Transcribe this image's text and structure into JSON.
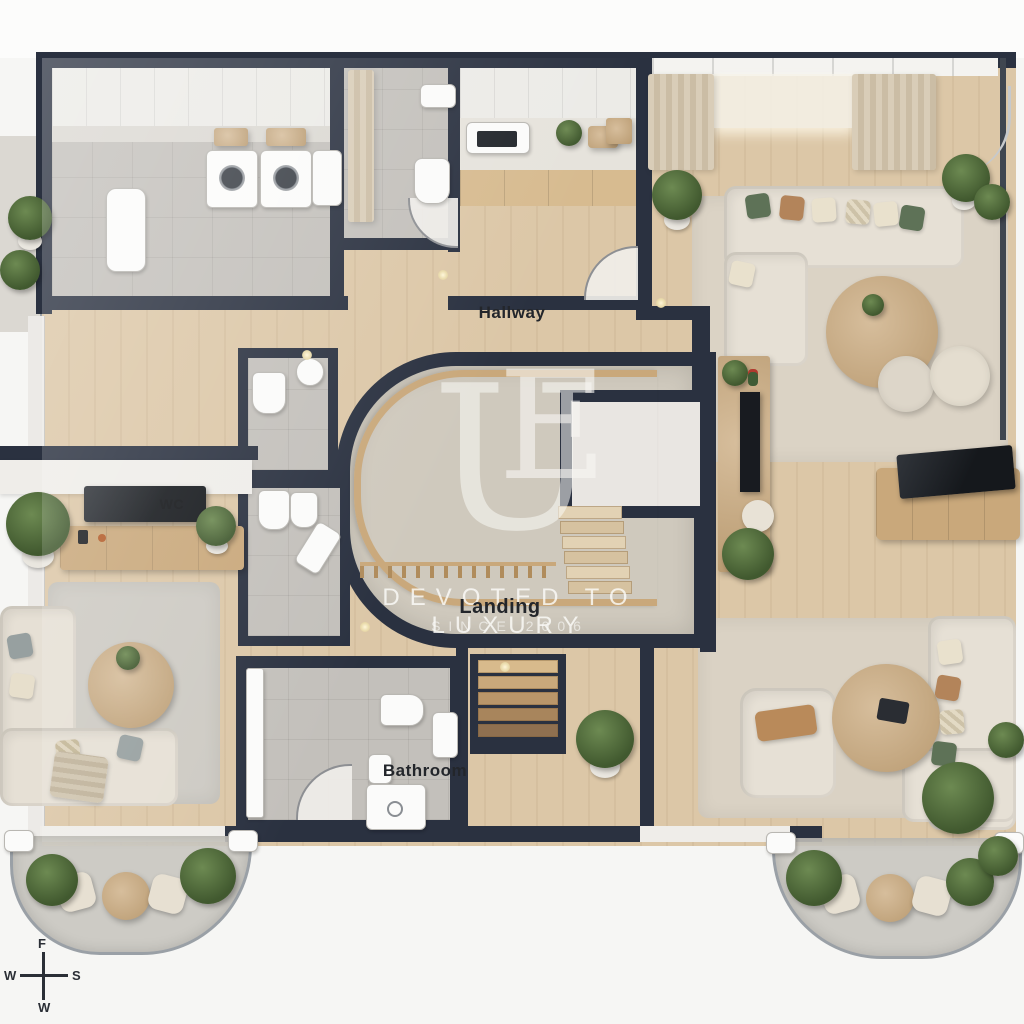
{
  "room_labels": {
    "hallway": "Hallway",
    "landing": "Landing",
    "bathroom": "Bathroom",
    "wc": "WC"
  },
  "watermark": {
    "letter_u": "U",
    "letter_e": "E",
    "tagline": "DEVOTED TO LUXURY",
    "since_line": "SINCE 2006"
  },
  "compass": {
    "top": "F",
    "left": "W",
    "right": "S",
    "bottom": "W"
  },
  "colors": {
    "wall": "#2a3140",
    "wood_floor": "#dcc7a7",
    "tile": "#c3c0bb",
    "landing_carpet": "#cfc9bd",
    "rug_beige": "#dbd3c5",
    "rug_gray": "#cdcac3",
    "sofa": "#e6e0d5",
    "wood_furniture": "#c9a87b",
    "curtain": "#d9cdb8",
    "plant_green": "#55713f",
    "tv_screen": "#1a1d22",
    "white_wall": "#efede9"
  }
}
